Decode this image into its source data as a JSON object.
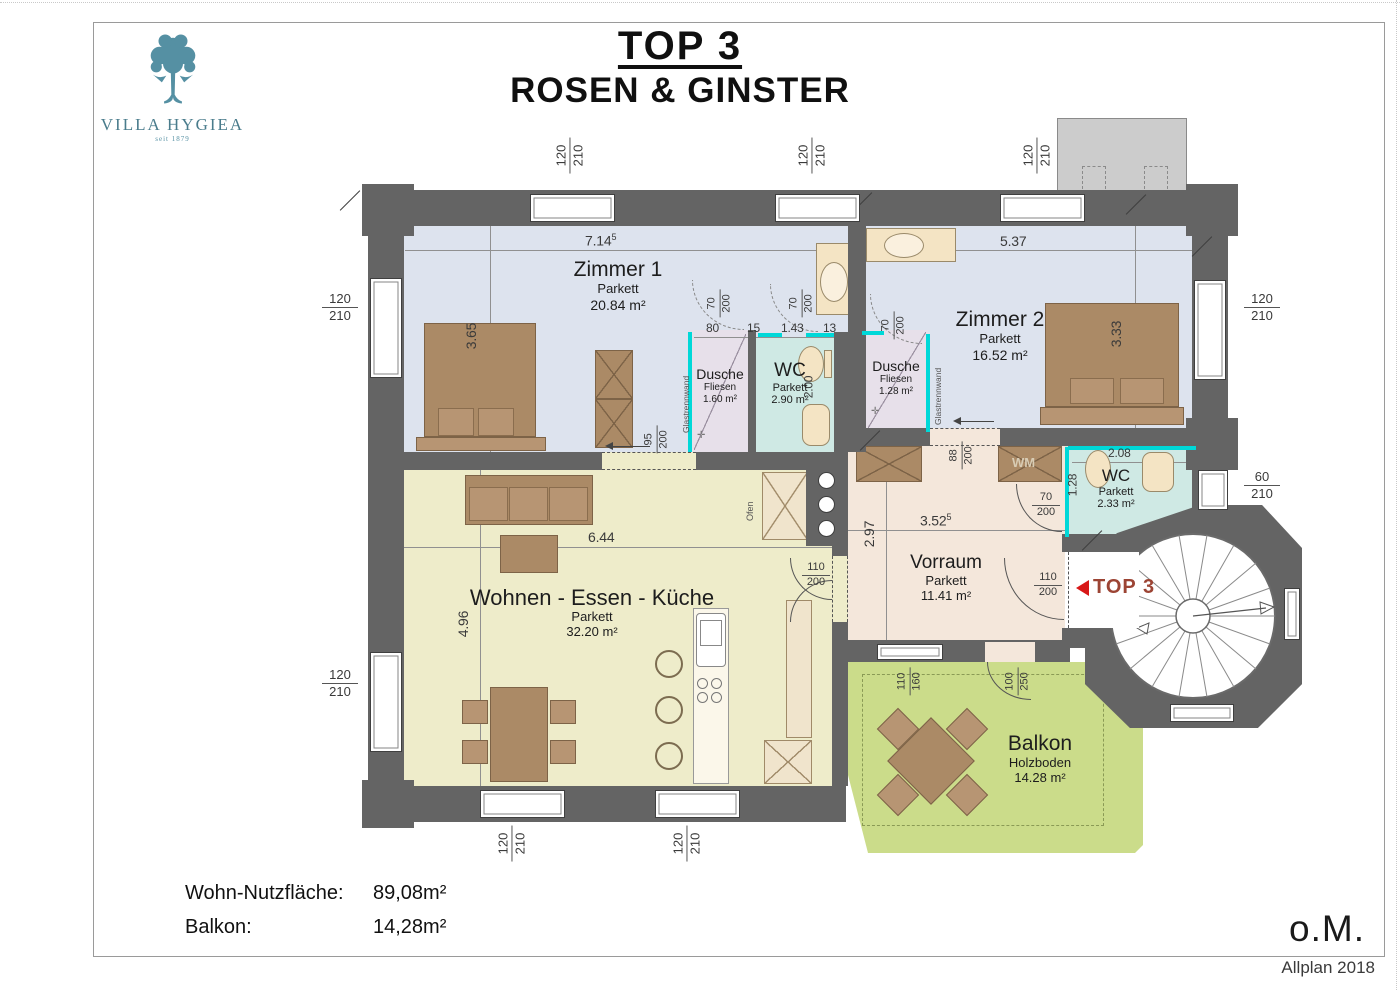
{
  "header": {
    "title": "TOP 3",
    "subtitle": "ROSEN & GINSTER"
  },
  "logo": {
    "name": "VILLA HYGIEA",
    "since": "seit 1879"
  },
  "rooms": {
    "zimmer1": {
      "name": "Zimmer 1",
      "floor": "Parkett",
      "area": "20.84 m²"
    },
    "zimmer2": {
      "name": "Zimmer 2",
      "floor": "Parkett",
      "area": "16.52 m²"
    },
    "dusche1": {
      "name": "Dusche",
      "floor": "Fliesen",
      "area": "1.60 m²"
    },
    "wc1": {
      "name": "WC",
      "floor": "Parkett",
      "area": "2.90 m²"
    },
    "dusche2": {
      "name": "Dusche",
      "floor": "Fliesen",
      "area": "1.28 m²"
    },
    "wc2": {
      "name": "WC",
      "floor": "Parkett",
      "area": "2.33 m²"
    },
    "wohnen": {
      "name": "Wohnen - Essen - Küche",
      "floor": "Parkett",
      "area": "32.20 m²"
    },
    "vorraum": {
      "name": "Vorraum",
      "floor": "Parkett",
      "area": "11.41 m²"
    },
    "balkon": {
      "name": "Balkon",
      "floor": "Holzboden",
      "area": "14.28 m²"
    }
  },
  "dims": {
    "w120": "120",
    "h210": "210",
    "w60": "60",
    "w95": "95",
    "h200": "200",
    "w70": "70",
    "w88": "88",
    "w110": "110",
    "h160": "160",
    "w100": "100",
    "h250": "250",
    "len714": "7.14",
    "len714sup": "5",
    "len537": "5.37",
    "len365": "3.65",
    "len333": "3.33",
    "len644": "6.44",
    "len496": "4.96",
    "len297": "2.97",
    "len352": "3.52",
    "len352sup": "5",
    "len208": "2.08",
    "len200": "2.00",
    "len128": "1.28",
    "seg80": "80",
    "seg15": "15",
    "seg143": "1.43",
    "seg13": "13"
  },
  "annotations": {
    "glass": "Glastrennwand",
    "wm": "WM",
    "ofen": "Ofen",
    "unit_marker": "TOP 3"
  },
  "footer": {
    "area_label": "Wohn-Nutzfläche:",
    "area_value": "89,08m²",
    "balcony_label": "Balkon:",
    "balcony_value": "14,28m²",
    "scale_note": "o.M.",
    "software": "Allplan 2018"
  },
  "colors": {
    "wall": "#646464",
    "zimmer_fill": "#dde3ee",
    "wohnen_fill": "#eeecca",
    "vorraum_fill": "#f4e7db",
    "balkon_fill": "#cbdc8a",
    "dusche_fill": "#e7e0ea",
    "wc_fill": "#cfe9e4",
    "glass": "#00d8d8",
    "furniture": "#ab8a66",
    "fixture": "#f4e4c4",
    "logo": "#5590a3",
    "marker_arrow": "#d81818",
    "marker_text": "#9c4434"
  }
}
